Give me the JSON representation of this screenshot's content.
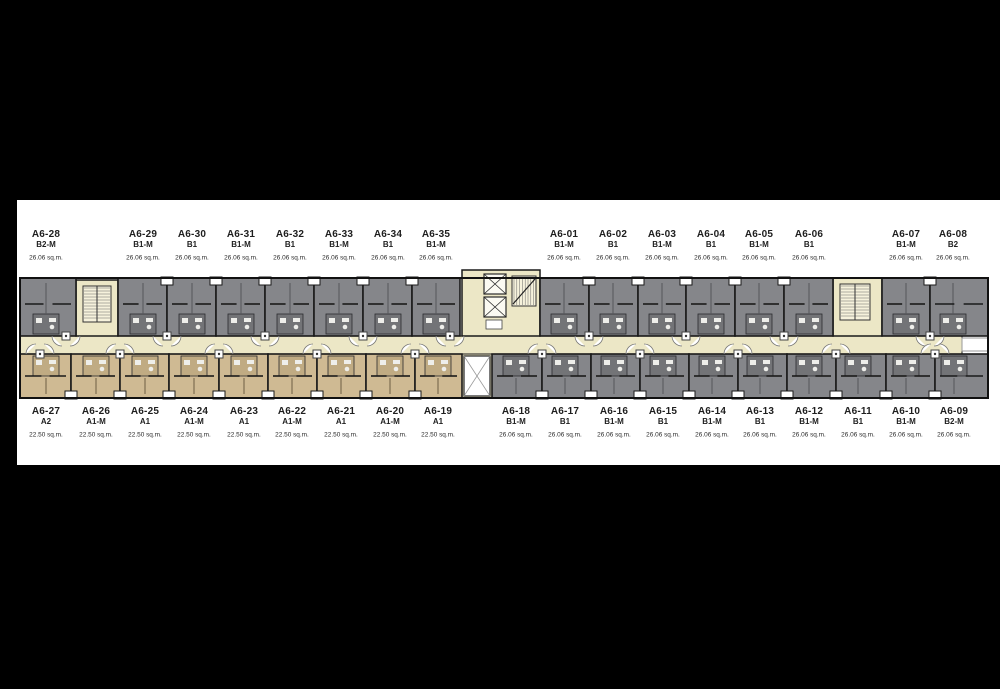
{
  "page": {
    "background": "#000000",
    "panel_background": "#ffffff"
  },
  "plan": {
    "colors": {
      "unit_gray": "#85868a",
      "unit_tan": "#cfba93",
      "corridor_cream": "#ece7c6",
      "stair_fill": "#f6f2dc",
      "bath_gray": "#737477",
      "bath_tan": "#c0ab83",
      "wall": "#1a1a1a",
      "label_text": "#1e1e1e"
    },
    "top_row": [
      {
        "id": "A6-28",
        "type": "B2-M",
        "area": "26.06 sq.m.",
        "fill": "gray",
        "x1": 20,
        "x2": 76,
        "cx": 46
      },
      {
        "id": "A6-29",
        "type": "B1-M",
        "area": "26.06 sq.m.",
        "fill": "gray",
        "x1": 118,
        "x2": 167,
        "cx": 143
      },
      {
        "id": "A6-30",
        "type": "B1",
        "area": "26.06 sq.m.",
        "fill": "gray",
        "x1": 167,
        "x2": 216,
        "cx": 192
      },
      {
        "id": "A6-31",
        "type": "B1-M",
        "area": "26.06 sq.m.",
        "fill": "gray",
        "x1": 216,
        "x2": 265,
        "cx": 241
      },
      {
        "id": "A6-32",
        "type": "B1",
        "area": "26.06 sq.m.",
        "fill": "gray",
        "x1": 265,
        "x2": 314,
        "cx": 290
      },
      {
        "id": "A6-33",
        "type": "B1-M",
        "area": "26.06 sq.m.",
        "fill": "gray",
        "x1": 314,
        "x2": 363,
        "cx": 339
      },
      {
        "id": "A6-34",
        "type": "B1",
        "area": "26.06 sq.m.",
        "fill": "gray",
        "x1": 363,
        "x2": 412,
        "cx": 388
      },
      {
        "id": "A6-35",
        "type": "B1-M",
        "area": "26.06 sq.m.",
        "fill": "gray",
        "x1": 412,
        "x2": 460,
        "cx": 436
      },
      {
        "id": "A6-01",
        "type": "B1-M",
        "area": "26.06 sq.m.",
        "fill": "gray",
        "x1": 540,
        "x2": 589,
        "cx": 564
      },
      {
        "id": "A6-02",
        "type": "B1",
        "area": "26.06 sq.m.",
        "fill": "gray",
        "x1": 589,
        "x2": 638,
        "cx": 613
      },
      {
        "id": "A6-03",
        "type": "B1-M",
        "area": "26.06 sq.m.",
        "fill": "gray",
        "x1": 638,
        "x2": 686,
        "cx": 662
      },
      {
        "id": "A6-04",
        "type": "B1",
        "area": "26.06 sq.m.",
        "fill": "gray",
        "x1": 686,
        "x2": 735,
        "cx": 711
      },
      {
        "id": "A6-05",
        "type": "B1-M",
        "area": "26.06 sq.m.",
        "fill": "gray",
        "x1": 735,
        "x2": 784,
        "cx": 759
      },
      {
        "id": "A6-06",
        "type": "B1",
        "area": "26.06 sq.m.",
        "fill": "gray",
        "x1": 784,
        "x2": 833,
        "cx": 809
      },
      {
        "id": "A6-07",
        "type": "B1-M",
        "area": "26.06 sq.m.",
        "fill": "gray",
        "x1": 882,
        "x2": 930,
        "cx": 906
      },
      {
        "id": "A6-08",
        "type": "B2",
        "area": "26.06 sq.m.",
        "fill": "gray",
        "x1": 930,
        "x2": 988,
        "cx": 953
      }
    ],
    "bottom_row": [
      {
        "id": "A6-27",
        "type": "A2",
        "area": "22.50 sq.m.",
        "fill": "tan",
        "x1": 20,
        "x2": 71,
        "cx": 46
      },
      {
        "id": "A6-26",
        "type": "A1-M",
        "area": "22.50 sq.m.",
        "fill": "tan",
        "x1": 71,
        "x2": 120,
        "cx": 96
      },
      {
        "id": "A6-25",
        "type": "A1",
        "area": "22.50 sq.m.",
        "fill": "tan",
        "x1": 120,
        "x2": 169,
        "cx": 145
      },
      {
        "id": "A6-24",
        "type": "A1-M",
        "area": "22.50 sq.m.",
        "fill": "tan",
        "x1": 169,
        "x2": 219,
        "cx": 194
      },
      {
        "id": "A6-23",
        "type": "A1",
        "area": "22.50 sq.m.",
        "fill": "tan",
        "x1": 219,
        "x2": 268,
        "cx": 244
      },
      {
        "id": "A6-22",
        "type": "A1-M",
        "area": "22.50 sq.m.",
        "fill": "tan",
        "x1": 268,
        "x2": 317,
        "cx": 292
      },
      {
        "id": "A6-21",
        "type": "A1",
        "area": "22.50 sq.m.",
        "fill": "tan",
        "x1": 317,
        "x2": 366,
        "cx": 341
      },
      {
        "id": "A6-20",
        "type": "A1-M",
        "area": "22.50 sq.m.",
        "fill": "tan",
        "x1": 366,
        "x2": 415,
        "cx": 390
      },
      {
        "id": "A6-19",
        "type": "A1",
        "area": "22.50 sq.m.",
        "fill": "tan",
        "x1": 415,
        "x2": 462,
        "cx": 438
      },
      {
        "id": "A6-18",
        "type": "B1-M",
        "area": "26.06 sq.m.",
        "fill": "gray",
        "x1": 492,
        "x2": 542,
        "cx": 516
      },
      {
        "id": "A6-17",
        "type": "B1",
        "area": "26.06 sq.m.",
        "fill": "gray",
        "x1": 542,
        "x2": 591,
        "cx": 565
      },
      {
        "id": "A6-16",
        "type": "B1-M",
        "area": "26.06 sq.m.",
        "fill": "gray",
        "x1": 591,
        "x2": 640,
        "cx": 614
      },
      {
        "id": "A6-15",
        "type": "B1",
        "area": "26.06 sq.m.",
        "fill": "gray",
        "x1": 640,
        "x2": 689,
        "cx": 663
      },
      {
        "id": "A6-14",
        "type": "B1-M",
        "area": "26.06 sq.m.",
        "fill": "gray",
        "x1": 689,
        "x2": 738,
        "cx": 712
      },
      {
        "id": "A6-13",
        "type": "B1",
        "area": "26.06 sq.m.",
        "fill": "gray",
        "x1": 738,
        "x2": 787,
        "cx": 760
      },
      {
        "id": "A6-12",
        "type": "B1-M",
        "area": "26.06 sq.m.",
        "fill": "gray",
        "x1": 787,
        "x2": 836,
        "cx": 809
      },
      {
        "id": "A6-11",
        "type": "B1",
        "area": "26.06 sq.m.",
        "fill": "gray",
        "x1": 836,
        "x2": 886,
        "cx": 858
      },
      {
        "id": "A6-10",
        "type": "B1-M",
        "area": "26.06 sq.m.",
        "fill": "gray",
        "x1": 886,
        "x2": 935,
        "cx": 906
      },
      {
        "id": "A6-09",
        "type": "B2-M",
        "area": "26.06 sq.m.",
        "fill": "gray",
        "x1": 935,
        "x2": 988,
        "cx": 954
      }
    ],
    "features": {
      "stair_left": {
        "x1": 76,
        "x2": 118
      },
      "core": {
        "x1": 462,
        "x2": 540
      },
      "stair_right": {
        "x1": 833,
        "x2": 882
      },
      "shaft": {
        "x1": 462,
        "x2": 492
      },
      "corridor_exit": {
        "x1": 962,
        "x2": 988
      }
    },
    "entries": {
      "top": [
        66,
        167,
        265,
        363,
        450,
        589,
        686,
        784,
        930
      ],
      "bottom": [
        40,
        120,
        219,
        317,
        415,
        542,
        640,
        738,
        836,
        935
      ]
    }
  }
}
